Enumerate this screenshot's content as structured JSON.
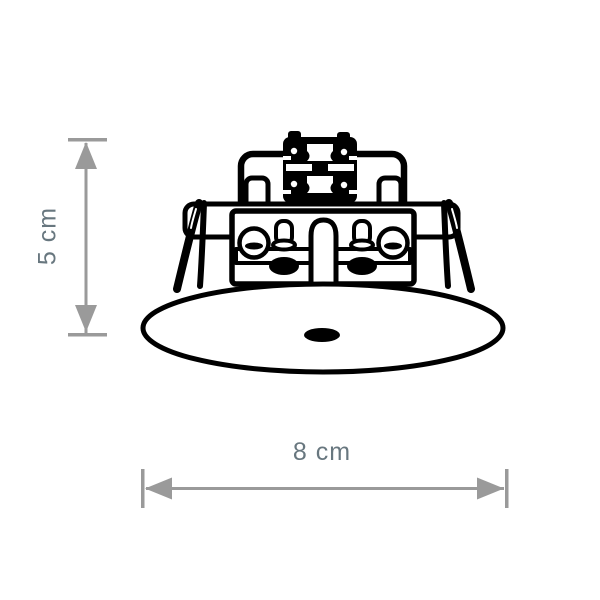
{
  "diagram": {
    "type": "product-dimension-drawing",
    "subject": "recessed-ceiling-fixture",
    "colors": {
      "background": "#ffffff",
      "drawing_line": "#000000",
      "dimension_arrow": "#9a9a9a",
      "dimension_label": "#68777f"
    },
    "dimensions": {
      "height": {
        "label": "5 cm",
        "orientation": "vertical"
      },
      "width": {
        "label": "8 cm",
        "orientation": "horizontal"
      }
    },
    "icons": {
      "vertical_arrow": "double-ended-arrow-icon",
      "horizontal_arrow": "double-ended-arrow-icon"
    }
  }
}
